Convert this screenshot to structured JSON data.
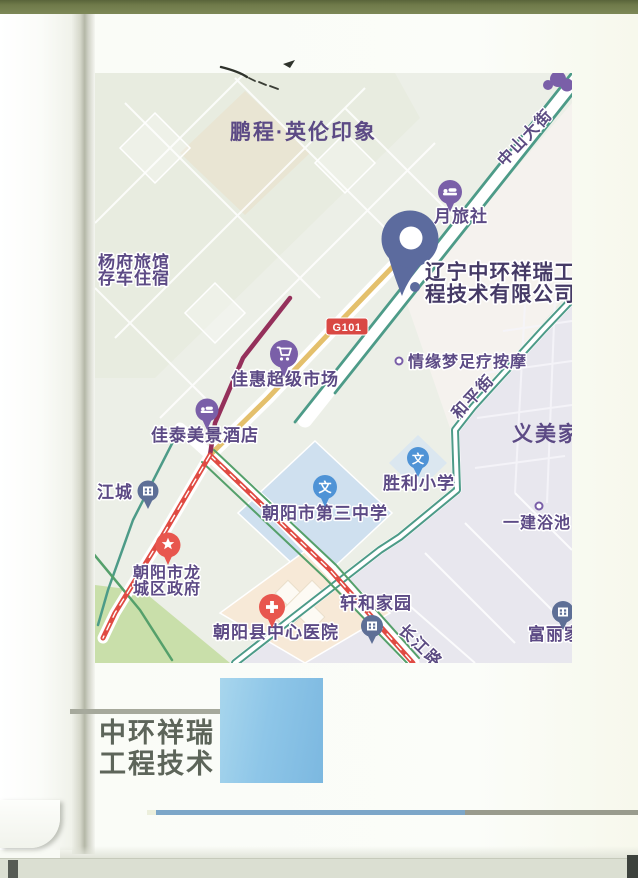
{
  "colors": {
    "brand-blue": "#8ec6e8",
    "bar-blue": "#7ca6c8",
    "bar-grey": "#999b8d",
    "road-teal": "#4d9b88",
    "road-yellow": "#e4c06c",
    "road-crimson": "#95305b",
    "road-red": "#e04b43",
    "road-green": "#55a06b",
    "pin-purple": "#7a5fa8",
    "pin-blue": "#4f93d6",
    "pin-red": "#e8564e",
    "pin-slate": "#5c6b9e",
    "pin-grey": "#5e6f96",
    "label-purple": "#5c4a85",
    "label-dark": "#453a66",
    "badge-red": "#d94843"
  },
  "map": {
    "school_glyph": "文",
    "district_labels": {
      "pengcheng": "鹏程·英伦印象",
      "yimeijia": "义美家"
    },
    "roads": {
      "zhongshan_dajie": "中山大街",
      "heping_jie": "和平街",
      "changjiang_lu": "长江路",
      "g101_badge": "G101"
    },
    "pois": {
      "yangfu_line1": "杨府旅馆",
      "yangfu_line2": "存车住宿",
      "lvshe": "月旅社",
      "company_line1": "辽宁中环祥瑞工",
      "company_line2": "程技术有限公司",
      "supermarket": "佳惠超级市场",
      "foot_massage": "情缘梦足疗按摩",
      "jiatai_hotel": "佳泰美景酒店",
      "jiangcheng": "江城",
      "shengli_school": "胜利小学",
      "no3_school": "朝阳市第三中学",
      "yijian_bath": "一建浴池",
      "gov_line1": "朝阳市龙",
      "gov_line2": "城区政府",
      "xuanhe": "轩和家园",
      "hospital": "朝阳县中心医院",
      "fuli": "富丽家"
    }
  },
  "footer": {
    "logo_line1": "中环祥瑞",
    "logo_line2": "工程技术"
  }
}
